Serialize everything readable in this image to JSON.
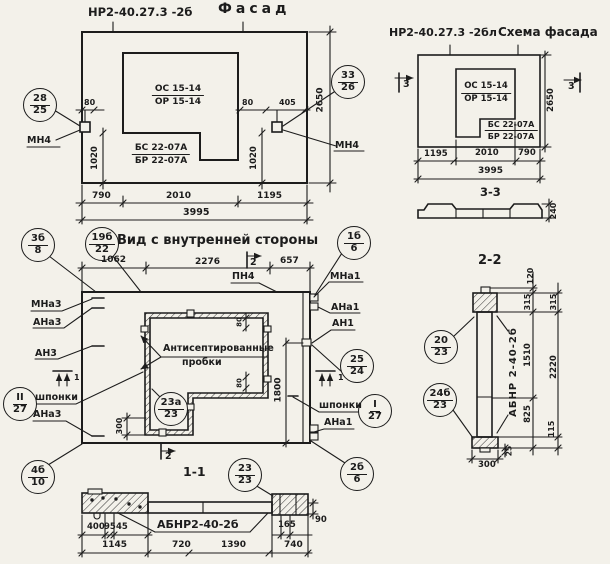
{
  "palette": {
    "ink": "#1c1c1c",
    "paper": "#f3f1ea"
  },
  "facade": {
    "code": "НР2-40.27.3 -2б",
    "title": "Фасад",
    "window_mark_num": "ОС 15-14",
    "window_mark_den": "ОР 15-14",
    "panel_mark_num": "БС 22-07А",
    "panel_mark_den": "БР 22-07А",
    "callout_left_num": "28",
    "callout_left_den": "25",
    "callout_right_num": "33",
    "callout_right_den": "26",
    "anchor_left": "МН4",
    "anchor_right": "МН4",
    "dim_offset_left": "80",
    "dim_offset_right": "80",
    "dim_405": "405",
    "dim_1020_left": "1020",
    "dim_1020_right": "1020",
    "dim_2650": "2650",
    "dim_790": "790",
    "dim_2010": "2010",
    "dim_1195": "1195",
    "dim_3995": "3995"
  },
  "scheme": {
    "code": "НР2-40.27.3 -2бл",
    "title": "Схема фасада",
    "window_mark_num": "ОС 15-14",
    "window_mark_den": "ОР 15-14",
    "panel_mark_num": "БС 22-07А",
    "panel_mark_den": "БР 22-07А",
    "marker_left": "3",
    "marker_right": "3",
    "dim_2650": "2650",
    "dim_1195": "1195",
    "dim_2010": "2010",
    "dim_790": "790",
    "dim_3995": "3995",
    "profile_label": "3-3",
    "profile_dim": "240"
  },
  "section22": {
    "label": "2-2",
    "panel_code": "АБНР 2-40-2б",
    "callout_top_num": "20",
    "callout_top_den": "23",
    "callout_bot_num": "24б",
    "callout_bot_den": "23",
    "dim_120": "120",
    "dim_315_a": "315",
    "dim_1510": "1510",
    "dim_825": "825",
    "dim_315_b": "315",
    "dim_2220": "2220",
    "dim_115": "115",
    "dim_25": "25",
    "dim_300": "300"
  },
  "inner": {
    "title": "Вид с внутренней стороны",
    "note_line1": "Антисептированные",
    "note_line2": "пробки",
    "dim_1062": "1062",
    "dim_2276": "2276",
    "dim_657": "657",
    "dim_1800": "1800",
    "dim_300": "300",
    "dim_80_top": "80",
    "dim_80_bot": "80",
    "label_pn4": "ПН4",
    "label_mna3": "МНа3",
    "label_ana3": "АНа3",
    "label_an3": "АН3",
    "label_shponki_left": "шпонки",
    "label_ana3_low": "АНа3",
    "label_mna1": "МНа1",
    "label_ana1": "АНа1",
    "label_an1": "АН1",
    "label_shponki_right": "шпонки",
    "label_ana1_low": "АНа1",
    "marker1": "1",
    "marker2": "2",
    "callouts": {
      "c3b8_num": "3б",
      "c3b8_den": "8",
      "c19b22_num": "19б",
      "c19b22_den": "22",
      "c1b6_num": "1б",
      "c1b6_den": "6",
      "c2524_num": "25",
      "c2524_den": "24",
      "cI27_num": "I",
      "cI27_den": "27",
      "cII27_num": "II",
      "cII27_den": "27",
      "c23a_num": "23а",
      "c23a_den": "23",
      "c4b10_num": "4б",
      "c4b10_den": "10",
      "c2b6_num": "2б",
      "c2b6_den": "6"
    }
  },
  "section11": {
    "label": "1-1",
    "panel_code": "АБНР2-40-2б",
    "callout_num": "23",
    "callout_den": "23",
    "dim_400": "400",
    "dim_95": "95",
    "dim_45": "45",
    "dim_165": "165",
    "dim_90": "90",
    "dim_1145": "1145",
    "dim_720": "720",
    "dim_1390": "1390",
    "dim_740": "740"
  }
}
